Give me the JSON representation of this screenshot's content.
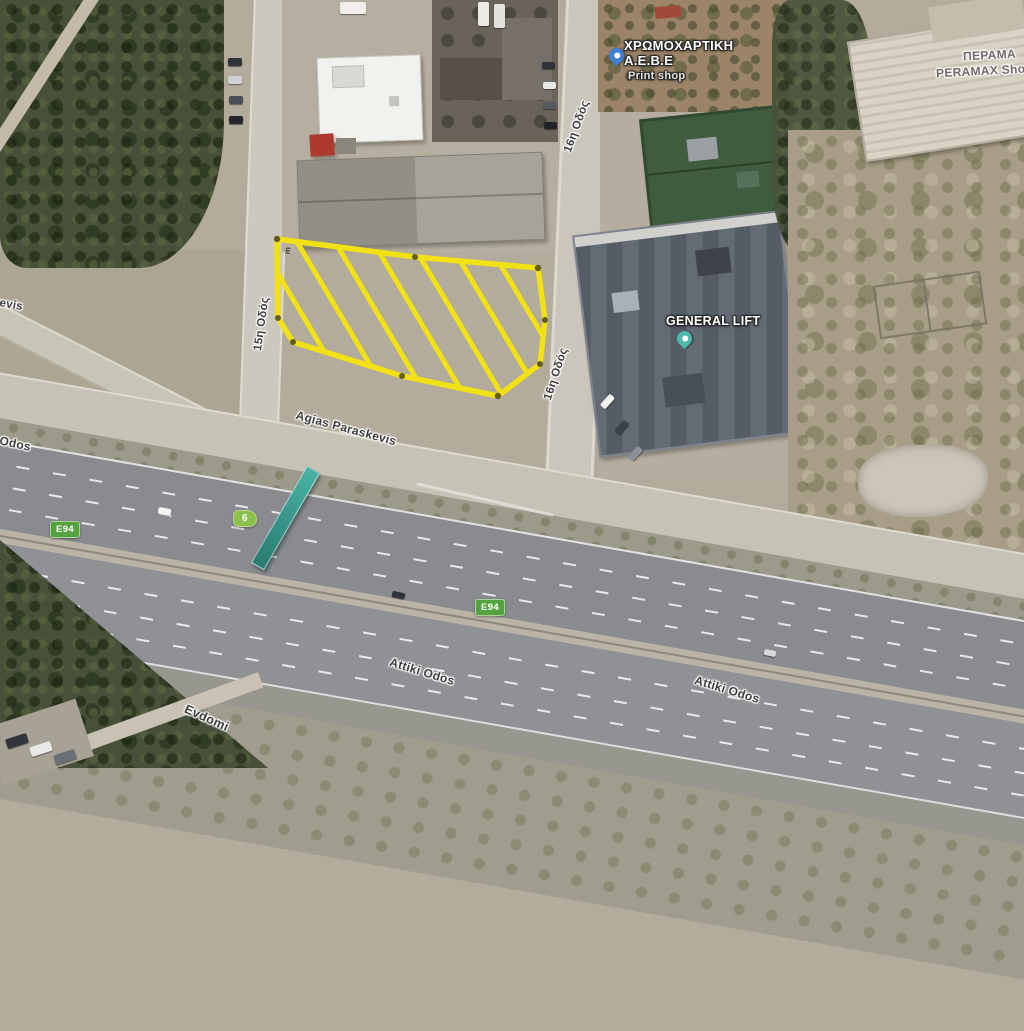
{
  "map": {
    "type": "satellite-aerial-view",
    "poi": {
      "print_shop": {
        "line1": "ΧΡΩΜΟΧΑΡΤΙΚΗ",
        "line2": "Α.Ε.Β.Ε",
        "line3": "Print shop"
      },
      "peramax": {
        "line1": "ΠΕΡΑΜΑ",
        "line2": "PERAMAX Sho"
      },
      "general_lift": {
        "name": "GENERAL LIFT"
      }
    },
    "roads": {
      "r15": "15η Οδός",
      "r16_top": "16η Οδός",
      "r16_bottom": "16η Οδός",
      "agias_paraskevis": "Agias Paraskevis",
      "paraskevis_clip": "kevis",
      "attiki_clip": "i Odos",
      "attiki_1": "Attiki Odos",
      "attiki_2": "Attiki Odos",
      "evdomi": "Evdomi"
    },
    "badges": {
      "e94_left": "E94",
      "e94_mid": "E94",
      "exit": "6"
    },
    "parcel": {
      "measure_unit": "m",
      "outline_color": "#f2e115"
    },
    "colors": {
      "badge_green": "#55a33e",
      "exit_green": "#8cbf4b",
      "pin_blue": "#3f7fd4",
      "pin_teal": "#4db9ac",
      "trees": "#47513a",
      "asphalt": "#8a8b8f"
    }
  }
}
